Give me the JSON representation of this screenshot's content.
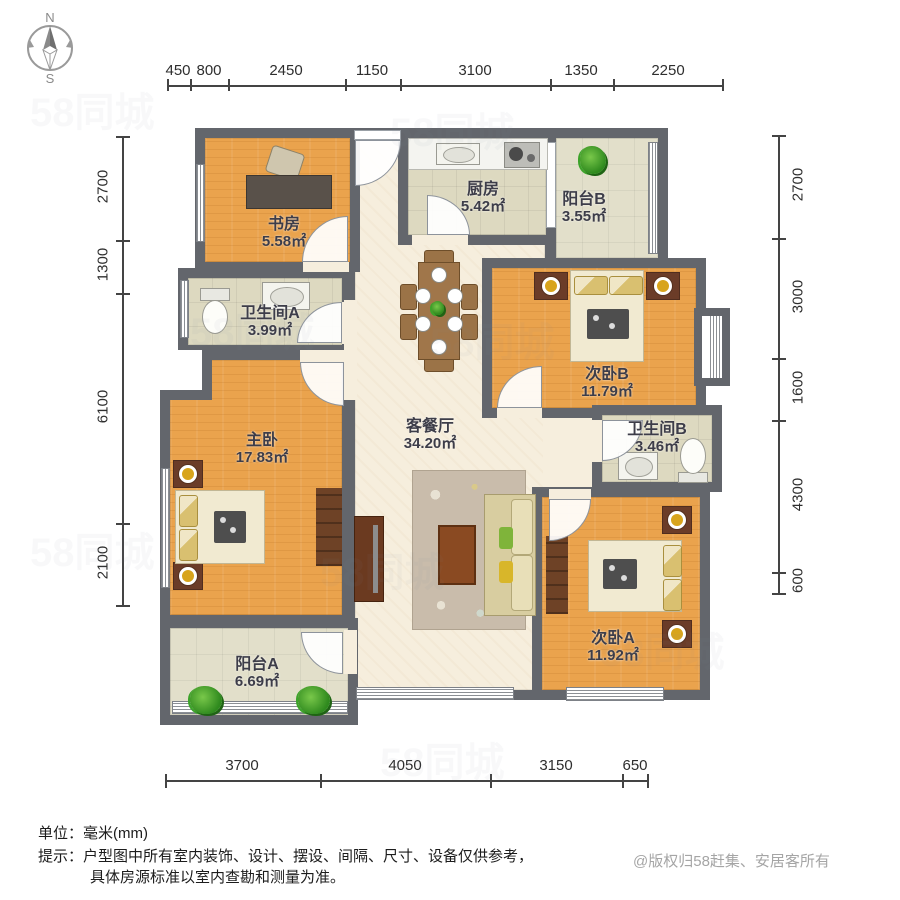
{
  "compass": {
    "north": "N",
    "south": "S"
  },
  "dimensions": {
    "top": [
      "450",
      "800",
      "2450",
      "1150",
      "3100",
      "1350",
      "2250"
    ],
    "left": [
      "2700",
      "1300",
      "6100",
      "2100"
    ],
    "right": [
      "2700",
      "3000",
      "1600",
      "4300",
      "600"
    ],
    "bottom": [
      "3700",
      "4050",
      "3150",
      "650"
    ]
  },
  "rooms": [
    {
      "id": "study",
      "name": "书房",
      "area": "5.58㎡"
    },
    {
      "id": "kitchen",
      "name": "厨房",
      "area": "5.42㎡"
    },
    {
      "id": "balcony_b",
      "name": "阳台B",
      "area": "3.55㎡"
    },
    {
      "id": "bath_a",
      "name": "卫生间A",
      "area": "3.99㎡"
    },
    {
      "id": "bedroom_b",
      "name": "次卧B",
      "area": "11.79㎡"
    },
    {
      "id": "living",
      "name": "客餐厅",
      "area": "34.20㎡"
    },
    {
      "id": "master",
      "name": "主卧",
      "area": "17.83㎡"
    },
    {
      "id": "bath_b",
      "name": "卫生间B",
      "area": "3.46㎡"
    },
    {
      "id": "bedroom_a",
      "name": "次卧A",
      "area": "11.92㎡"
    },
    {
      "id": "balcony_a",
      "name": "阳台A",
      "area": "6.69㎡"
    }
  ],
  "notes": {
    "unit_label": "单位：",
    "unit_value": "毫米(mm)",
    "tip_label": "提示：",
    "tip_line1": "户型图中所有室内装饰、设计、摆设、间隔、尺寸、设备仅供参考，",
    "tip_line2": "具体房源标准以室内查勘和测量为准。",
    "copyright": "@版权归58赶集、安居客所有"
  },
  "watermark": {
    "text": "58同城"
  },
  "colors": {
    "wall": "#63666c",
    "wood_floor": "#eaa34d",
    "tile_floor": "#ddd9c0",
    "living_floor": "#f6eedd",
    "accent_brown": "#6e4226"
  }
}
